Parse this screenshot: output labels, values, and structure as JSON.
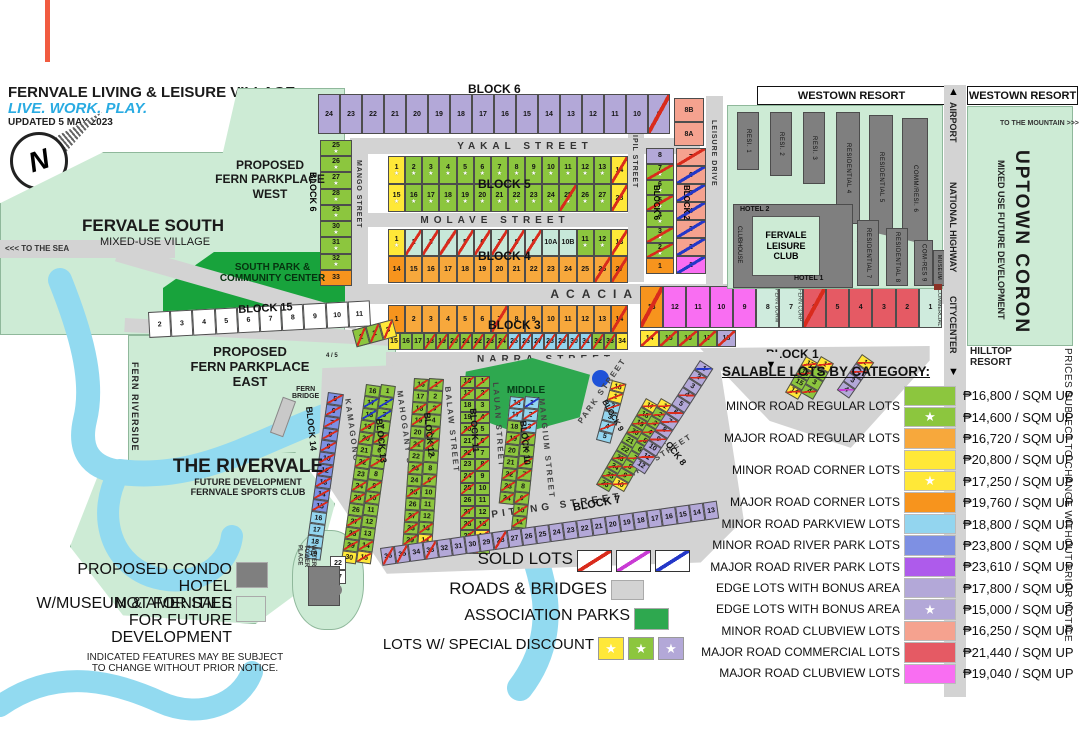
{
  "colors": {
    "minor_regular": "#8CC63E",
    "major_regular": "#F7A83C",
    "minor_corner": "#FFE838",
    "major_corner": "#F7941D",
    "minor_parkview": "#93D5EF",
    "minor_riverpark": "#7E90E3",
    "major_riverpark": "#AE5BEB",
    "edge_bonus": "#B3A8D8",
    "minor_clubview": "#F5A28F",
    "major_commercial": "#E55A64",
    "major_clubview": "#F96EF2",
    "commercial_pale": "#CFEBDD",
    "teal": "#C7E8D9",
    "open": "#FFFFFF",
    "sold_red": "#D92B1C",
    "sold_magenta": "#C93BD4",
    "sold_blue": "#2437C8",
    "road": "#D3D3D3",
    "park": "#2EA84F",
    "south_park": "#18A33C",
    "not_for_sale": "#CDEBD5",
    "river": "#92DAF0",
    "building": "#7F7F7F",
    "accent_line": "#F15B40"
  },
  "header": {
    "title": "FERNVALE LIVING & LEISURE VILLAGE",
    "tagline": "LIVE. WORK. PLAY.",
    "updated": "UPDATED 5 MAY 2023"
  },
  "compass": {
    "letter": "N"
  },
  "places": {
    "park_west": "PROPOSED\nFERN PARKPLACE\nWEST",
    "fervale_south": "FERVALE SOUTH",
    "fervale_south_sub": "MIXED-USE VILLAGE",
    "south_park": "SOUTH PARK &\nCOMMUNITY CENTER",
    "park_east": "PROPOSED\nFERN PARKPLACE\nEAST",
    "to_the_sea": "<<< TO THE SEA",
    "fern_riverside": "FERN RIVERSIDE",
    "fern_bridge": "FERN\nBRIDGE",
    "rivervale": "THE RIVERVALE",
    "rivervale_sub1": "FUTURE DEVELOPMENT",
    "rivervale_sub2": "FERNVALE SPORTS CLUB",
    "water_tower": "WATER\nTOWER\nPLACE",
    "middle_park": "MIDDLE\nPARK",
    "lot45": "4 / 5"
  },
  "streets": {
    "yakal": "YAKAL STREET",
    "molave": "MOLAVE STREET",
    "acacia": "ACACIA AVENUE",
    "narra": "NARRA STREET",
    "mango": "MANGO STREET",
    "ipil_top": "IPIL STREET",
    "leisure": "LEISURE DRIVE",
    "kamagong": "KAMAGONG STREET",
    "mahogany": "MAHOGANY STREET",
    "balaw": "BALAW STREET",
    "lauan": "LAUAN STREET",
    "mangium": "MANGIUM STREET",
    "park": "PARK STREET",
    "ipil_fan": "IPIL STREET",
    "apitong": "APITONG STREET"
  },
  "blocks": {
    "b1": "BLOCK 1",
    "b2": "BLOCK 2",
    "b3": "BLOCK 3",
    "b4": "BLOCK 4",
    "b5": "BLOCK 5",
    "b6": "BLOCK 6",
    "b7": "BLOCK 7",
    "b8": "BLOCK 8",
    "b9": "BLOCK 9",
    "b10": "BLOCK 10",
    "b11": "BLOCK 11",
    "b12": "BLOCK 12",
    "b13": "BLOCK 13",
    "b14": "BLOCK 14",
    "b15": "BLOCK 15"
  },
  "lots": {
    "b6_row": [
      "24|e",
      "23|e",
      "22|e",
      "21|e",
      "20|e",
      "19|e",
      "18|e",
      "17|e",
      "16|e",
      "15|e",
      "14|e",
      "13|e",
      "12|e",
      "11|e",
      "10|e",
      "9|e|r"
    ],
    "b6_left": [
      "25|g||*",
      "26|g||*",
      "27|g||*",
      "28|g||*",
      "29|g||*",
      "30|g||*",
      "31|g||*",
      "32|g||*",
      "33|oc"
    ],
    "b8ab": [
      "8B|sa",
      "8A|sa"
    ],
    "b5_r1": [
      "1|y||*",
      "2|g||*",
      "3|g||*",
      "4|g||*",
      "5|g||*",
      "6|g||*",
      "7|g||*",
      "8|g||*",
      "9|g||*",
      "10|g||*",
      "11|g||*",
      "12|g||*",
      "13|g||*",
      "14|y|r"
    ],
    "b5_r2": [
      "15|y||*",
      "16|g||*",
      "17|g||*",
      "18|g||*",
      "19|g||*",
      "20|g||*",
      "21|g||*",
      "22|g||*",
      "23|g||*",
      "24|g||*",
      "25|g|r|*",
      "26|g||*",
      "27|g||*",
      "28|y|r"
    ],
    "b4_r1": [
      "1|y||*",
      "2|t|r",
      "3|t|r",
      "4|t|r",
      "5|t|r",
      "6|t|r",
      "7|t|r",
      "8|t|r",
      "9|t|r",
      "10A|t",
      "10B|t",
      "11|g||*",
      "12|g||*",
      "13|y|r"
    ],
    "b4_r2": [
      "14|oc",
      "15|o",
      "16|o",
      "17|o",
      "18|o",
      "19|o",
      "20|o",
      "21|o",
      "22|o",
      "23|o",
      "24|o",
      "25|o",
      "26|o|r",
      "27|oc|r"
    ],
    "b3_r1": [
      "1|oc",
      "2|o",
      "3|o",
      "4|o",
      "5|o",
      "6|o",
      "7|o|r",
      "8|o",
      "9|o",
      "10|o",
      "11|o",
      "12|o",
      "13|o",
      "14|oc|r"
    ],
    "b3_r2": [
      "15|y",
      "16|g",
      "17|g",
      "18|g|r",
      "19|g|r",
      "20|g|r",
      "21|g|r",
      "22|g|r",
      "23|g|r",
      "24|g|r",
      "25|pv|r",
      "26|pv|r",
      "27|pv|r",
      "28|pv|r",
      "29|pv|r",
      "30|pv|r",
      "31|pv|r",
      "32|g|r",
      "33|g|r",
      "34|y"
    ],
    "b6_green": [
      "8|e",
      "7|g|r|*",
      "6|g||*",
      "5|g|r|*",
      "4|g||*",
      "3|g|r|*",
      "2|g|r|*",
      "1|oc"
    ],
    "b2_col": [
      "7|sa|r",
      "6|sa|b",
      "5|sa|b",
      "4|sa|b",
      "3|sa|b",
      "2|sa|b",
      "1|m|b"
    ],
    "b1_row": [
      "13|oc|r",
      "12|m",
      "11|m",
      "10|m",
      "9|m",
      "8|c|||FERN DORM",
      "7|c|||FERN CORP",
      "6|re|r",
      "5|re",
      "4|re",
      "3|re",
      "2|re",
      "1|c|||COMMERCIAL"
    ],
    "b1_row2": [
      "14|y|r",
      "15|g|r",
      "16|g|r",
      "17|g|r",
      "18|e|r"
    ],
    "b15_row": [
      "2|w",
      "3|w",
      "4|w",
      "5|w",
      "6|w",
      "7|w",
      "8|w",
      "9|w",
      "10|w",
      "11|w"
    ],
    "b15_end": [
      "1|g|r",
      "2|g|r",
      "3|y|r"
    ],
    "b14_col": [
      "5|rp|r",
      "6|rp|r",
      "7|rp|r",
      "8|rp|r",
      "9|rp|r",
      "10|rp|r",
      "12|rp|r",
      "13|rp|r",
      "14|rp|r",
      "15|rp|r",
      "16|pv",
      "17|pv",
      "18|pv",
      "19|pv"
    ],
    "b13_a": [
      "16|g",
      "17|g|b",
      "18|g|b",
      "19|g|r",
      "20|g|r",
      "21|g",
      "22|g|r",
      "23|g",
      "24|g|r",
      "25|g|r",
      "26|g",
      "27|g|r",
      "28|g|r",
      "29|g|r",
      "30|y"
    ],
    "b13_b": [
      "1|g",
      "2|g|b",
      "3|g|b",
      "4|g",
      "5|g|r",
      "6|g",
      "7|g|r",
      "8|g",
      "9|g|r",
      "10|g|r",
      "11|g",
      "12|g",
      "13|g",
      "14|g|r",
      "15|y|r"
    ],
    "b12_a": [
      "16|g|r",
      "17|g",
      "18|g|r",
      "19|g|r",
      "20|g",
      "21|g|r",
      "22|g",
      "23|g|r",
      "24|g",
      "25|g|r",
      "26|g",
      "27|g|r",
      "28|g|r",
      "29|g|r",
      "30|y|r"
    ],
    "b12_b": [
      "1|g|r",
      "2|g",
      "3|g|r",
      "4|g",
      "5|g|r",
      "6|g|r",
      "7|g",
      "8|g",
      "9|g|r",
      "10|g",
      "11|g",
      "12|g",
      "13|g|r",
      "14|y|r",
      "15|g"
    ],
    "b11_a": [
      "16|g|r",
      "17|g|r",
      "18|g",
      "19|g",
      "20|g|r",
      "21|g",
      "22|g|r",
      "23|g",
      "24|g|r",
      "25|g|r",
      "26|g",
      "27|g|r",
      "28|g|r",
      "29|g|r",
      "30|y|r"
    ],
    "b11_b": [
      "1|g|r",
      "2|g|r",
      "3|g",
      "4|g|r",
      "5|g",
      "6|g|r",
      "7|g",
      "8|g|r",
      "9|g",
      "10|g",
      "11|g",
      "12|g",
      "13|g|r",
      "14|y|r",
      "15|g|r"
    ],
    "b10_a": [
      "16|pv|r",
      "17|pv|r",
      "18|g",
      "19|g|r",
      "20|g",
      "21|g",
      "22|g|r",
      "23|g|r",
      "24|g|r"
    ],
    "b10_b": [
      "1|pv|b",
      "2|pv|r",
      "3|pv|r",
      "4|g|r",
      "5|g",
      "6|g|r",
      "7|g|r",
      "8|g",
      "9|g|r",
      "10|g|r",
      "11|g|r",
      "12|g|r"
    ],
    "b9_col": [
      "16|y|r",
      "1|y|r",
      "2|pv|r",
      "3|pv",
      "4|pv|r",
      "5|pv"
    ],
    "b8_a": [
      "17|y|r",
      "18|g|r",
      "19|g|r",
      "20|g|r",
      "21|g",
      "22|g",
      "23|g|r",
      "24|g|r",
      "25|g|r",
      "26|g|r"
    ],
    "b8_b": [
      "1|y|r",
      "2|g|r",
      "3|g|r",
      "4|g|r",
      "5|g|r",
      "6|g",
      "7|g|r",
      "8|g|r",
      "9|g|r",
      "10|y|r"
    ],
    "b8b_a": [
      "17|y|r",
      "16|g|r",
      "15|g",
      "14|y|r"
    ],
    "b8b_b": [
      "1|y|r",
      "2|g",
      "3|g",
      "4|g|r"
    ],
    "b8b_c": [
      "1|y|r",
      "2|e|r",
      "3|e",
      "4|e|m"
    ],
    "b7_strip": [
      "36|e|r",
      "35|e|r",
      "34|e",
      "33|e|r",
      "32|e",
      "31|e",
      "30|e",
      "29|e",
      "28|e|r",
      "27|e",
      "26|e",
      "25|e",
      "24|e",
      "23|e",
      "22|e",
      "21|e",
      "20|e",
      "19|e",
      "18|e",
      "17|e",
      "16|e",
      "15|e",
      "14|e",
      "13|e"
    ],
    "b7_edge": [
      "1|e|b",
      "2|e|r",
      "3|e",
      "4|e|r",
      "5|e",
      "6|e|r",
      "7|e|r",
      "8|e|r",
      "9|e|r",
      "10|e",
      "11|e|r",
      "12|e"
    ],
    "wt_lots": [
      "22|w",
      "37|w"
    ]
  },
  "legend": {
    "title": "SALABLE LOTS BY CATEGORY:",
    "unit": "/ SQM UP",
    "entries": [
      {
        "label": "MINOR ROAD REGULAR LOTS",
        "rows": [
          {
            "color": "#8CC63E",
            "star": false,
            "price": "₱16,800"
          },
          {
            "color": "#8CC63E",
            "star": true,
            "price": "₱14,600"
          }
        ]
      },
      {
        "label": "MAJOR ROAD REGULAR LOTS",
        "rows": [
          {
            "color": "#F7A83C",
            "star": false,
            "price": "₱16,720"
          }
        ]
      },
      {
        "label": "MINOR ROAD CORNER LOTS",
        "rows": [
          {
            "color": "#FFE838",
            "star": false,
            "price": "₱20,800"
          },
          {
            "color": "#FFE838",
            "star": true,
            "price": "₱17,250"
          }
        ]
      },
      {
        "label": "MAJOR ROAD CORNER LOTS",
        "rows": [
          {
            "color": "#F7941D",
            "star": false,
            "price": "₱19,760"
          }
        ]
      },
      {
        "label": "MINOR ROAD PARKVIEW LOTS",
        "rows": [
          {
            "color": "#93D5EF",
            "star": false,
            "price": "₱18,800"
          }
        ]
      },
      {
        "label": "MINOR ROAD RIVER PARK LOTS",
        "rows": [
          {
            "color": "#7E90E3",
            "star": false,
            "price": "₱23,800"
          }
        ]
      },
      {
        "label": "MAJOR ROAD RIVER PARK LOTS",
        "rows": [
          {
            "color": "#AE5BEB",
            "star": false,
            "price": "₱23,610"
          }
        ]
      },
      {
        "label": "EDGE LOTS WITH BONUS AREA",
        "rows": [
          {
            "color": "#B3A8D8",
            "star": false,
            "price": "₱17,800"
          }
        ]
      },
      {
        "label": "EDGE LOTS WITH BONUS AREA",
        "rows": [
          {
            "color": "#B3A8D8",
            "star": true,
            "price": "₱15,000"
          }
        ]
      },
      {
        "label": "MINOR ROAD CLUBVIEW LOTS",
        "rows": [
          {
            "color": "#F5A28F",
            "star": false,
            "price": "₱16,250"
          }
        ]
      },
      {
        "label": "MAJOR ROAD COMMERCIAL LOTS",
        "rows": [
          {
            "color": "#E55A64",
            "star": false,
            "price": "₱21,440"
          }
        ]
      },
      {
        "label": "MAJOR ROAD CLUBVIEW LOTS",
        "rows": [
          {
            "color": "#F96EF2",
            "star": false,
            "price": "₱19,040"
          }
        ]
      }
    ]
  },
  "map_legend": {
    "sold": "SOLD LOTS",
    "roads": "ROADS & BRIDGES",
    "parks": "ASSOCIATION PARKS",
    "discount": "LOTS W/ SPECIAL DISCOUNT",
    "star": "★"
  },
  "footer": {
    "condo": "PROPOSED CONDO HOTEL\nW/MUSEUM & AMENITIES",
    "not_for_sale": "NOT FOR SALE\nFOR FUTURE DEVELOPMENT",
    "disclaimer": "INDICATED FEATURES MAY BE SUBJECT\nTO CHANGE WITHOUT PRIOR NOTICE."
  },
  "resort": {
    "name": "WESTOWN RESORT",
    "buildings": [
      "RESI. 1",
      "RESI. 2",
      "RESI. 3",
      "RESIDENTIAL 4",
      "RESIDENTIAL 5",
      "COMM/RESI. 6",
      "RESIDENTIAL 7",
      "RESIDENTIAL 8",
      "COM-RES 9"
    ],
    "club": "FERVALE\nLEISURE\nCLUB",
    "esplanade": "ESPLANADE",
    "hotel1": "HOTEL 1",
    "hotel2": "HOTEL 2",
    "clubhouse": "CLUBHOUSE",
    "museum": "MUSEUM"
  },
  "right_side": {
    "westown": "WESTOWN RESORT",
    "airport": "AIRPORT",
    "national_highway": "NATIONAL HIGHWAY",
    "citycenter": "CITYCENTER",
    "arrow_up": "▲",
    "arrow_down": "▼",
    "to_mountain": "TO THE MOUNTAIN >>>",
    "uptown": "UPTOWN CORON",
    "uptown_sub": "MIXED USE FUTURE DEVELOPMENT",
    "hilltop": "HILLTOP RESORT",
    "prices_note": "PRICES SUBJECT TO CHANGE WITHOUT PRIOR NOTICE"
  }
}
